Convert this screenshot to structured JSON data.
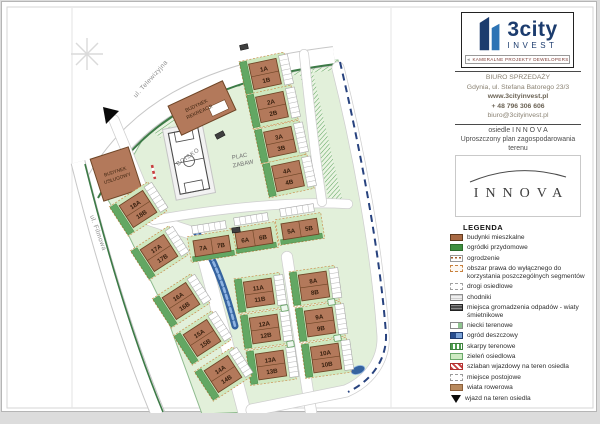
{
  "colors": {
    "building": "#b3795b",
    "garden": "#63a763",
    "estate_green": "#e2f0da",
    "rain_blue": "#35639f",
    "navy": "#1c3c6e",
    "blue": "#2e74b5",
    "barrier_red": "#c84040"
  },
  "map": {
    "street_top": "ul. Telewizyjna",
    "street_left": "ul. Filmowa",
    "boisko": "BOISKO",
    "plac_zabaw_1": "PLAC",
    "plac_zabaw_2": "ZABAW",
    "rekreacja_1": "BUDYNEK",
    "rekreacja_2": "REKREACJI",
    "uslugowy_1": "BUDYNEK",
    "uslugowy_2": "USŁUGOWY",
    "buildings": [
      {
        "a": "1A",
        "b": "1B"
      },
      {
        "a": "2A",
        "b": "2B"
      },
      {
        "a": "3A",
        "b": "3B"
      },
      {
        "a": "4A",
        "b": "4B"
      },
      {
        "a": "5A",
        "b": "5B"
      },
      {
        "a": "6A",
        "b": "6B"
      },
      {
        "a": "7A",
        "b": "7B"
      },
      {
        "a": "8A",
        "b": "8B"
      },
      {
        "a": "9A",
        "b": "9B"
      },
      {
        "a": "10A",
        "b": "10B"
      },
      {
        "a": "11A",
        "b": "11B"
      },
      {
        "a": "12A",
        "b": "12B"
      },
      {
        "a": "13A",
        "b": "13B"
      },
      {
        "a": "14A",
        "b": "14B"
      },
      {
        "a": "15A",
        "b": "15B"
      },
      {
        "a": "16A",
        "b": "16B"
      },
      {
        "a": "17A",
        "b": "17B"
      },
      {
        "a": "18A",
        "b": "18B"
      }
    ]
  },
  "panel": {
    "logo": {
      "brand": "3city",
      "sub": "INVEST",
      "tagline": "KAMERALNE PROJEKTY DEWELOPERSKIE"
    },
    "office": {
      "l1": "BIURO SPRZEDAŻY",
      "l2": "Gdynia, ul. Stefana Batorego 23/3",
      "l3": "www.3cityinvest.pl",
      "l4": "+ 48 796 306 606",
      "l5": "biuro@3cityinvest.pl"
    },
    "project": {
      "l1": "osiedle   I N N O V A",
      "l2": "Uproszczony plan zagospodarowania",
      "l3": "terenu"
    },
    "innova_logo": "INNOVA",
    "legend": {
      "title": "LEGENDA",
      "items": [
        {
          "label": "budynki mieszkalne",
          "swatch": "building"
        },
        {
          "label": "ogródki przydomowe",
          "swatch": "garden"
        },
        {
          "label": "ogrodzenie",
          "swatch": "fence"
        },
        {
          "label": "obszar prawa do wyłącznego do korzystania poszczególnych segmentów",
          "swatch": "exclusive"
        },
        {
          "label": "drogi osiedlowe",
          "swatch": "road"
        },
        {
          "label": "chodniki",
          "swatch": "sidewalk"
        },
        {
          "label": "miejsca gromadzenia odpadów - wiaty śmietnikowe",
          "swatch": "waste"
        },
        {
          "label": "niecki terenowe",
          "swatch": "basin"
        },
        {
          "label": "ogród deszczowy",
          "swatch": "rain"
        },
        {
          "label": "skarpy terenowe",
          "swatch": "slope"
        },
        {
          "label": "zieleń osiedlowa",
          "swatch": "green"
        },
        {
          "label": "szlaban wjazdowy na teren osiedla",
          "swatch": "barrier"
        },
        {
          "label": "miejsce postojowe",
          "swatch": "parking"
        },
        {
          "label": "wiata rowerowa",
          "swatch": "bike"
        },
        {
          "label": "wjazd na teren osiedla",
          "swatch": "entrance"
        }
      ]
    }
  }
}
